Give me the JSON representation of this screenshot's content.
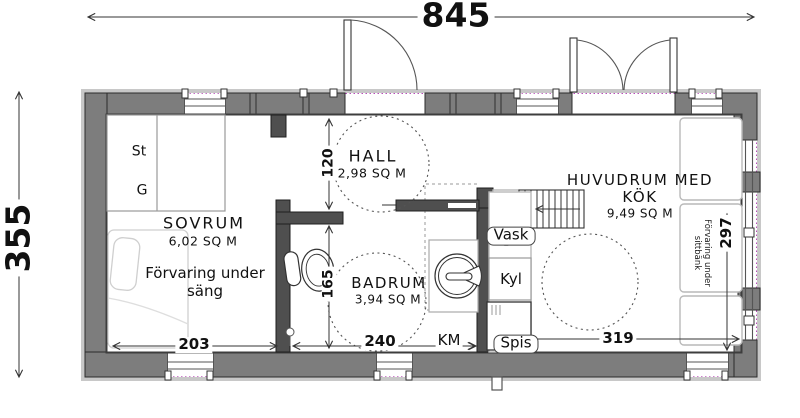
{
  "title": "Floor plan",
  "colors": {
    "wall_fill": "#7d7d7d",
    "interior_wall_fill": "#4f4f4f",
    "insulation_marker": "#b84db8",
    "trim": "#c8c8c8"
  },
  "dims": {
    "overall_width": "845",
    "overall_height": "355",
    "hall_depth": "120",
    "badrum_depth": "165",
    "sovrum_width": "203",
    "badrum_width": "240",
    "kok_width": "319",
    "kok_depth": "297"
  },
  "rooms": {
    "hall": {
      "name": "HALL",
      "area": "2,98 SQ M"
    },
    "sovrum": {
      "name": "SOVRUM",
      "area": "6,02 SQ M",
      "note_line1": "Förvaring under",
      "note_line2": "säng"
    },
    "badrum": {
      "name": "BADRUM",
      "area": "3,94 SQ M"
    },
    "huvudrum": {
      "name_line1": "HUVUDRUM MED",
      "name_line2": "KÖK",
      "area": "9,49 SQ M"
    }
  },
  "fixtures": {
    "closet_top": "St",
    "closet_bottom": "G",
    "sink": "Vask",
    "fridge": "Kyl",
    "washing_machine": "KM",
    "stove": "Spis",
    "bench_note_line1": "Förvaring under",
    "bench_note_line2": "sittbänk"
  }
}
